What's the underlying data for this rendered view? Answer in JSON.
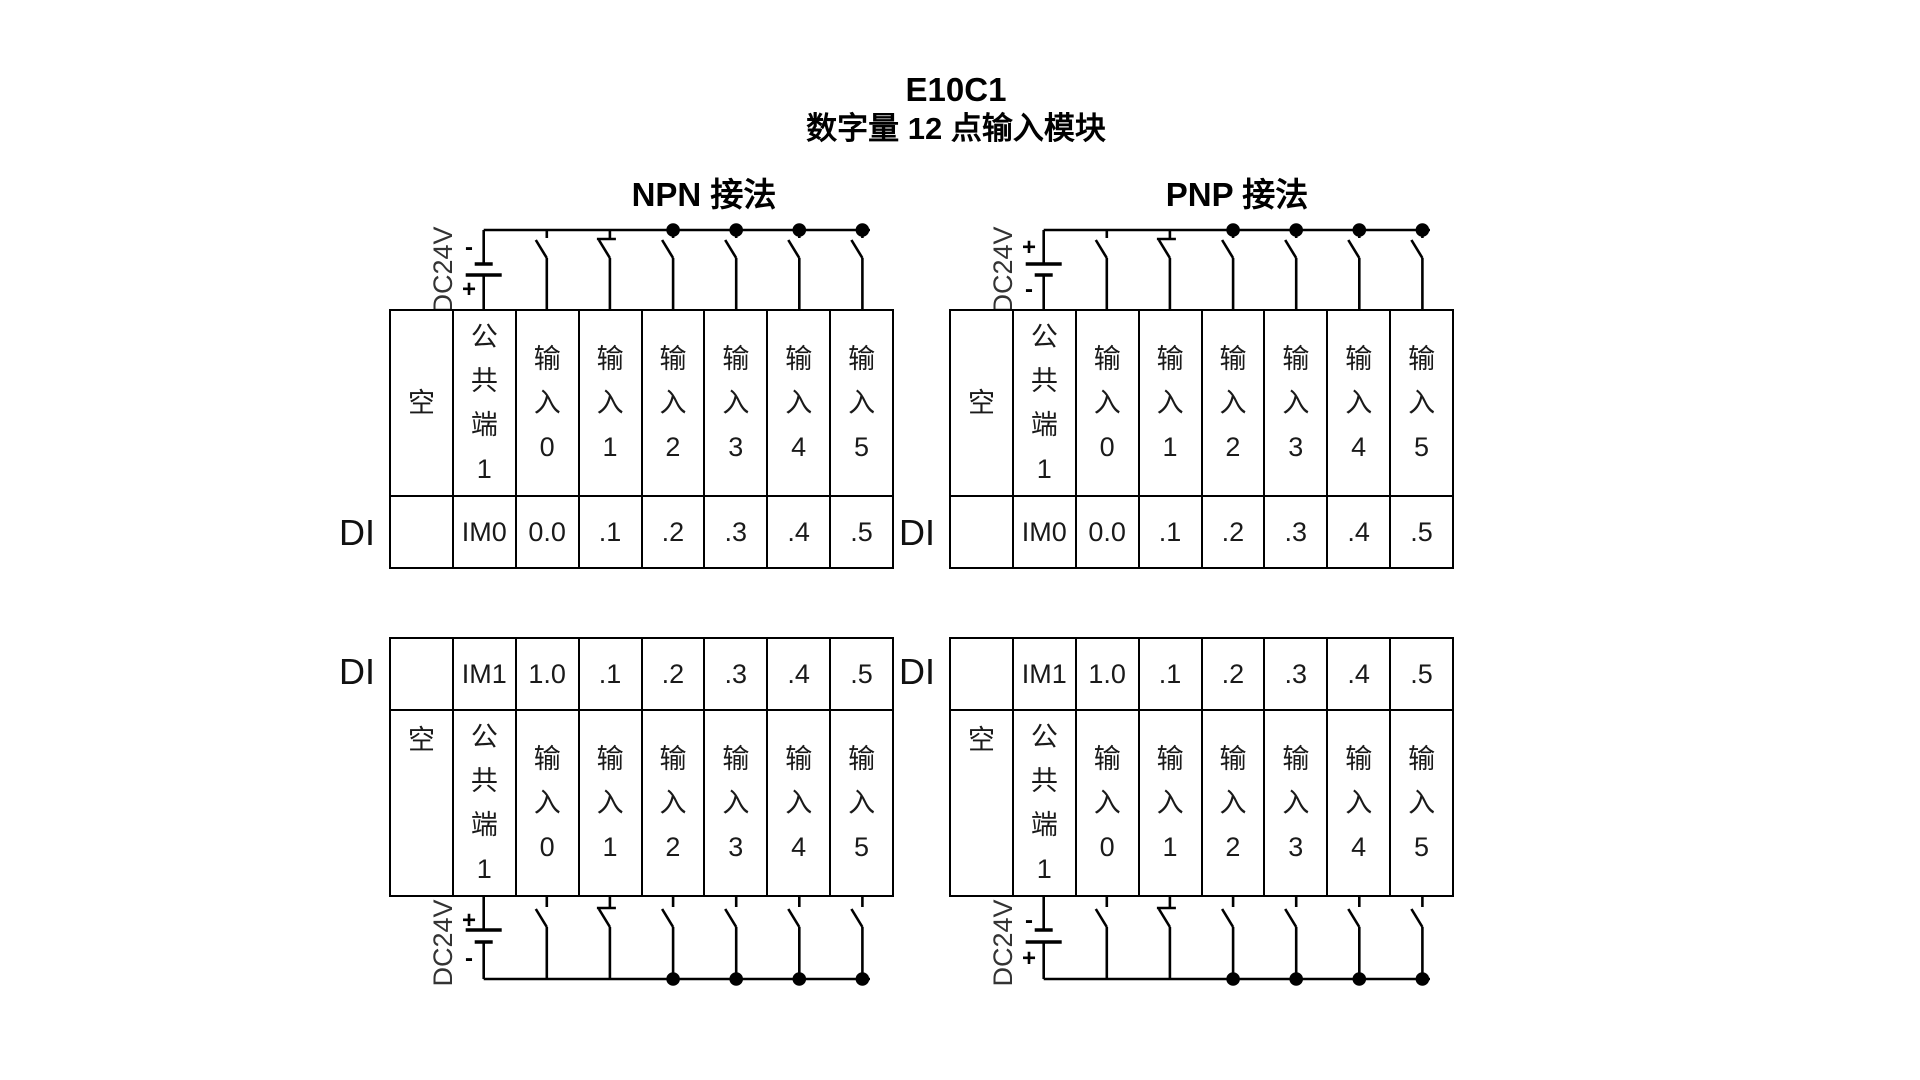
{
  "title": {
    "model": "E10C1",
    "subtitle": "数字量 12 点输入模块"
  },
  "sections": {
    "npn": "NPN 接法",
    "pnp": "PNP 接法"
  },
  "table": {
    "di_label": "DI",
    "headers": [
      "空",
      "公共端1",
      "输入0",
      "输入1",
      "输入2",
      "输入3",
      "输入4",
      "输入5"
    ],
    "row_im0": [
      "",
      "IM0",
      "0.0",
      ".1",
      ".2",
      ".3",
      ".4",
      ".5"
    ],
    "row_im1": [
      "",
      "IM1",
      "1.0",
      ".1",
      ".2",
      ".3",
      ".4",
      ".5"
    ]
  },
  "power": {
    "label": "DC24V",
    "npn_top": {
      "top": "-",
      "bottom": "+"
    },
    "pnp_top": {
      "top": "+",
      "bottom": "-"
    },
    "npn_bottom": {
      "top": "+",
      "bottom": "-"
    },
    "pnp_bottom": {
      "top": "-",
      "bottom": "+"
    }
  },
  "colors": {
    "line": "#000000",
    "background": "#ffffff"
  }
}
